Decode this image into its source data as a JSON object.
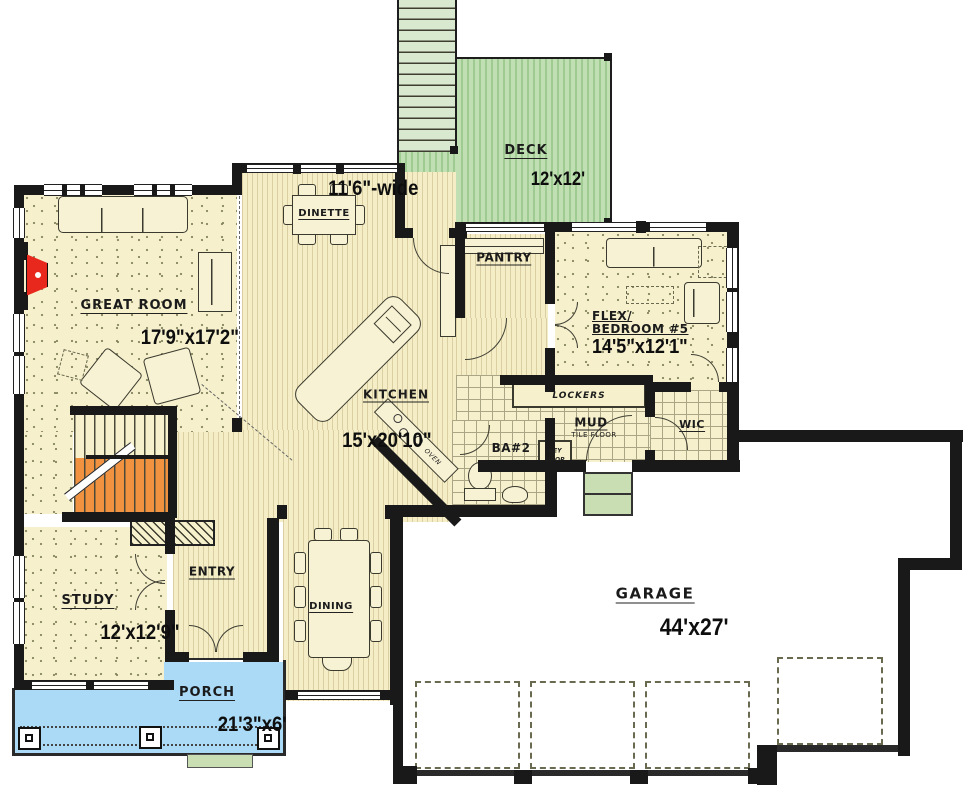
{
  "palette": {
    "wall": "#191919",
    "floor_cream": "#f6f0cc",
    "wood_stripe": "#d9cfa2",
    "deck_green": "#c0e0b4",
    "porch_blue": "#aadaf5",
    "stair_orange": "#f19240",
    "fireplace_red": "#e8271d",
    "step_green": "#c9dfb3"
  },
  "rooms": {
    "great_room": {
      "name": "GREAT ROOM",
      "dims": "17'9\"x17'2\""
    },
    "deck": {
      "name": "DECK",
      "dims": "12'x12'"
    },
    "dinette": {
      "label": "DINETTE",
      "width_note": "11'6\"-wide"
    },
    "pantry": {
      "name": "PANTRY"
    },
    "flex_bedroom": {
      "name_line1": "FLEX/",
      "name_line2": "BEDROOM #5",
      "dims": "14'5\"x12'1\""
    },
    "kitchen": {
      "name": "KITCHEN",
      "dims": "15'x20'10\"",
      "appliance_label": "OVEN"
    },
    "mud_room": {
      "name": "MUD",
      "floor_note": "TILE FLOOR",
      "bench_label": "LOCKERS",
      "key_drop_line1": "KEY",
      "key_drop_line2": "DROP"
    },
    "wic": {
      "name": "WIC"
    },
    "bath2": {
      "name": "BA#2"
    },
    "study": {
      "name": "STUDY",
      "dims": "12'x12'9\""
    },
    "entry": {
      "name": "ENTRY"
    },
    "dining": {
      "label": "DINING"
    },
    "porch": {
      "name": "PORCH",
      "dims": "21'3\"x6'"
    },
    "garage": {
      "name": "GARAGE",
      "dims": "44'x27'"
    }
  }
}
